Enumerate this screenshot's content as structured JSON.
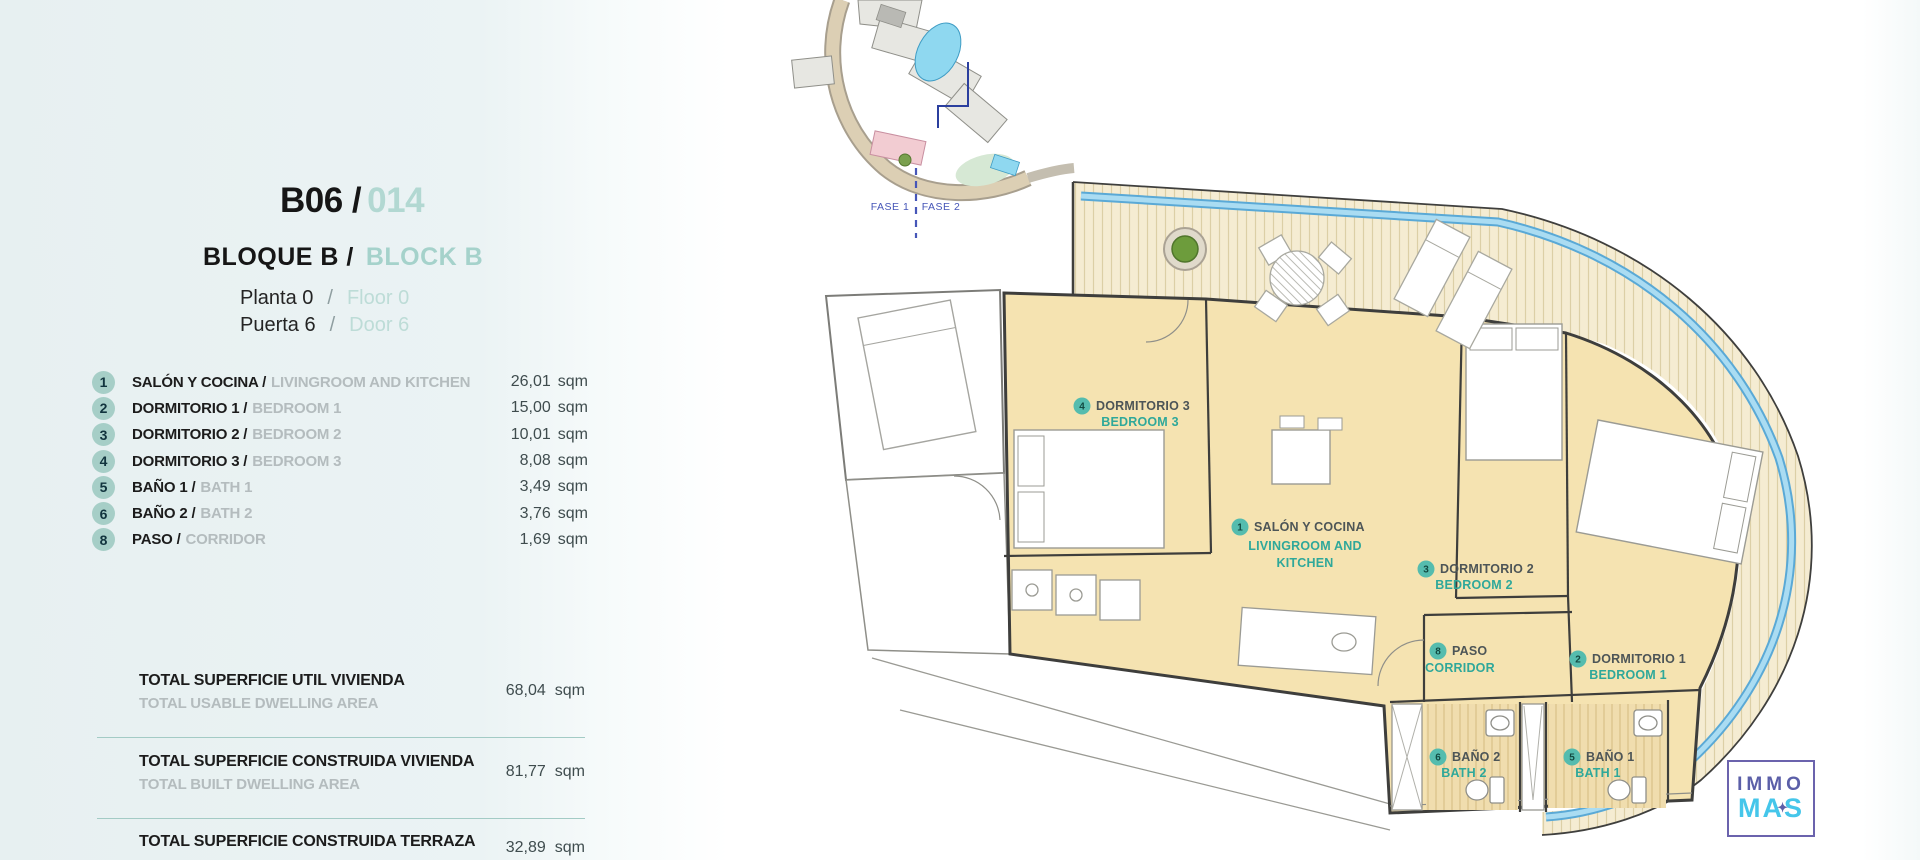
{
  "colors": {
    "accent_teal": "#2fa89a",
    "light_teal": "#aed6d0",
    "list_circle": "#a6cec7",
    "plan_room_fill": "#f5e3b1",
    "deck_fill": "#f5ecd2",
    "water_blue": "#8ecfec",
    "fase_blue": "#4656b8",
    "logo_purple": "#5b5fa8",
    "logo_cyan": "#45c6ea"
  },
  "header": {
    "code": "B06 /",
    "number": "014",
    "block_es": "BLOQUE B /",
    "block_en": "BLOCK B",
    "floor_es": "Planta 0",
    "floor_sep": "/",
    "floor_en": "Floor 0",
    "door_es": "Puerta 6",
    "door_sep": "/",
    "door_en": "Door 6"
  },
  "labels": {
    "sqm": "sqm"
  },
  "rooms": [
    {
      "num": "1",
      "es": "SALÓN Y COCINA /",
      "en": "LIVINGROOM AND KITCHEN",
      "area": "26,01"
    },
    {
      "num": "2",
      "es": "DORMITORIO 1 /",
      "en": "BEDROOM 1",
      "area": "15,00"
    },
    {
      "num": "3",
      "es": "DORMITORIO 2 /",
      "en": "BEDROOM 2",
      "area": "10,01"
    },
    {
      "num": "4",
      "es": "DORMITORIO 3 /",
      "en": "BEDROOM 3",
      "area": "8,08"
    },
    {
      "num": "5",
      "es": "BAÑO 1 /",
      "en": "BATH 1",
      "area": "3,49"
    },
    {
      "num": "6",
      "es": "BAÑO 2 /",
      "en": "BATH 2",
      "area": "3,76"
    },
    {
      "num": "8",
      "es": "PASO /",
      "en": "CORRIDOR",
      "area": "1,69"
    }
  ],
  "totals": [
    {
      "es": "TOTAL SUPERFICIE UTIL VIVIENDA",
      "en": "TOTAL USABLE DWELLING AREA",
      "value": "68,04"
    },
    {
      "es": "TOTAL SUPERFICIE CONSTRUIDA VIVIENDA",
      "en": "TOTAL BUILT DWELLING AREA",
      "value": "81,77"
    },
    {
      "es": "TOTAL SUPERFICIE CONSTRUIDA TERRAZA",
      "value": "32,89"
    }
  ],
  "site": {
    "fase1": "FASE 1",
    "fase2": "FASE 2"
  },
  "plan": {
    "rooms": [
      {
        "num": "4",
        "es": "DORMITORIO 3",
        "en": "BEDROOM 3"
      },
      {
        "num": "1",
        "es": "SALÓN Y COCINA",
        "en1": "LIVINGROOM AND",
        "en2": "KITCHEN"
      },
      {
        "num": "3",
        "es": "DORMITORIO 2",
        "en": "BEDROOM 2"
      },
      {
        "num": "8",
        "es": "PASO",
        "en": "CORRIDOR"
      },
      {
        "num": "2",
        "es": "DORMITORIO 1",
        "en": "BEDROOM 1"
      },
      {
        "num": "6",
        "es": "BAÑO 2",
        "en": "BATH 2"
      },
      {
        "num": "5",
        "es": "BAÑO 1",
        "en": "BATH 1"
      }
    ]
  },
  "logo": {
    "line1": "IMMO",
    "line2": "MAS",
    "mark": "✦"
  }
}
